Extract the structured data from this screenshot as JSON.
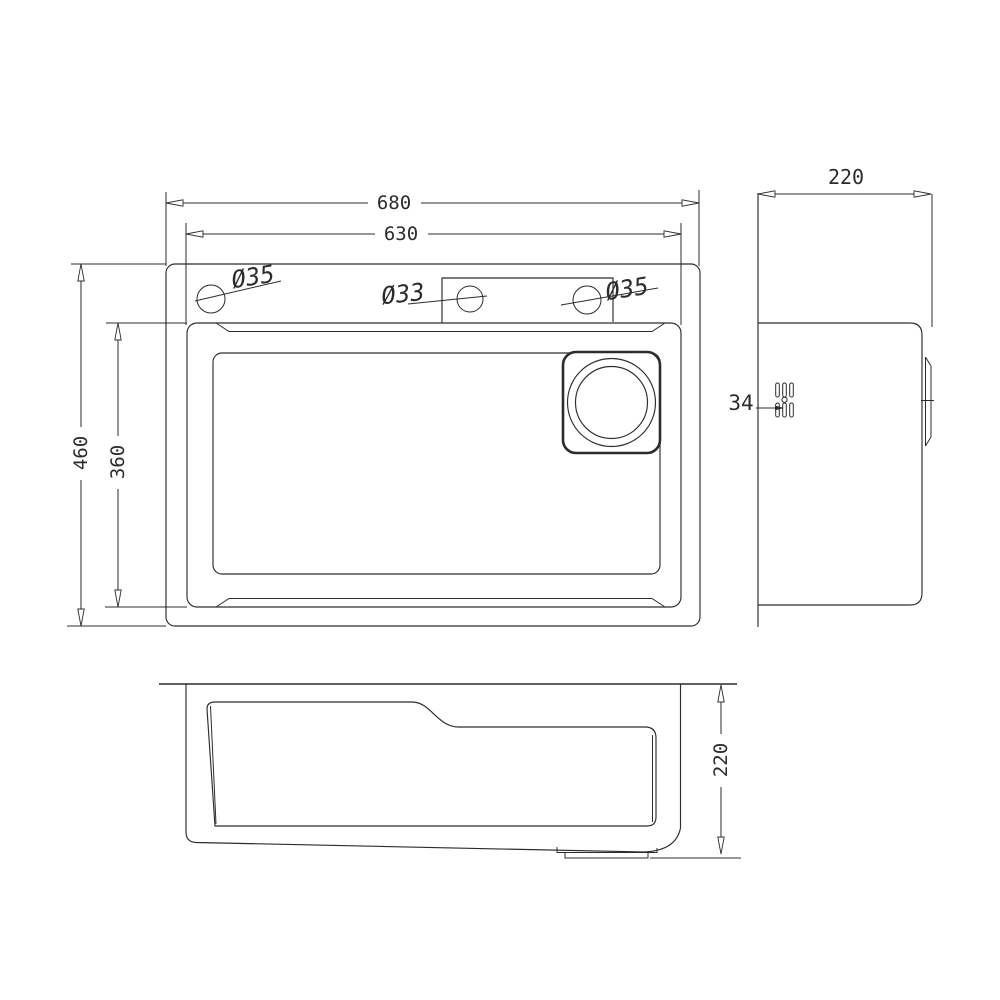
{
  "colors": {
    "ink": "#2c2c2c",
    "paper": "#ffffff"
  },
  "plan_view": {
    "outer_width": "680",
    "inner_width": "630",
    "outer_depth": "460",
    "inner_depth": "360",
    "hole_left": "Ø35",
    "hole_center": "Ø33",
    "hole_right": "Ø35"
  },
  "side_view": {
    "height": "220",
    "drain": "34"
  },
  "front_view": {
    "height": "220"
  }
}
